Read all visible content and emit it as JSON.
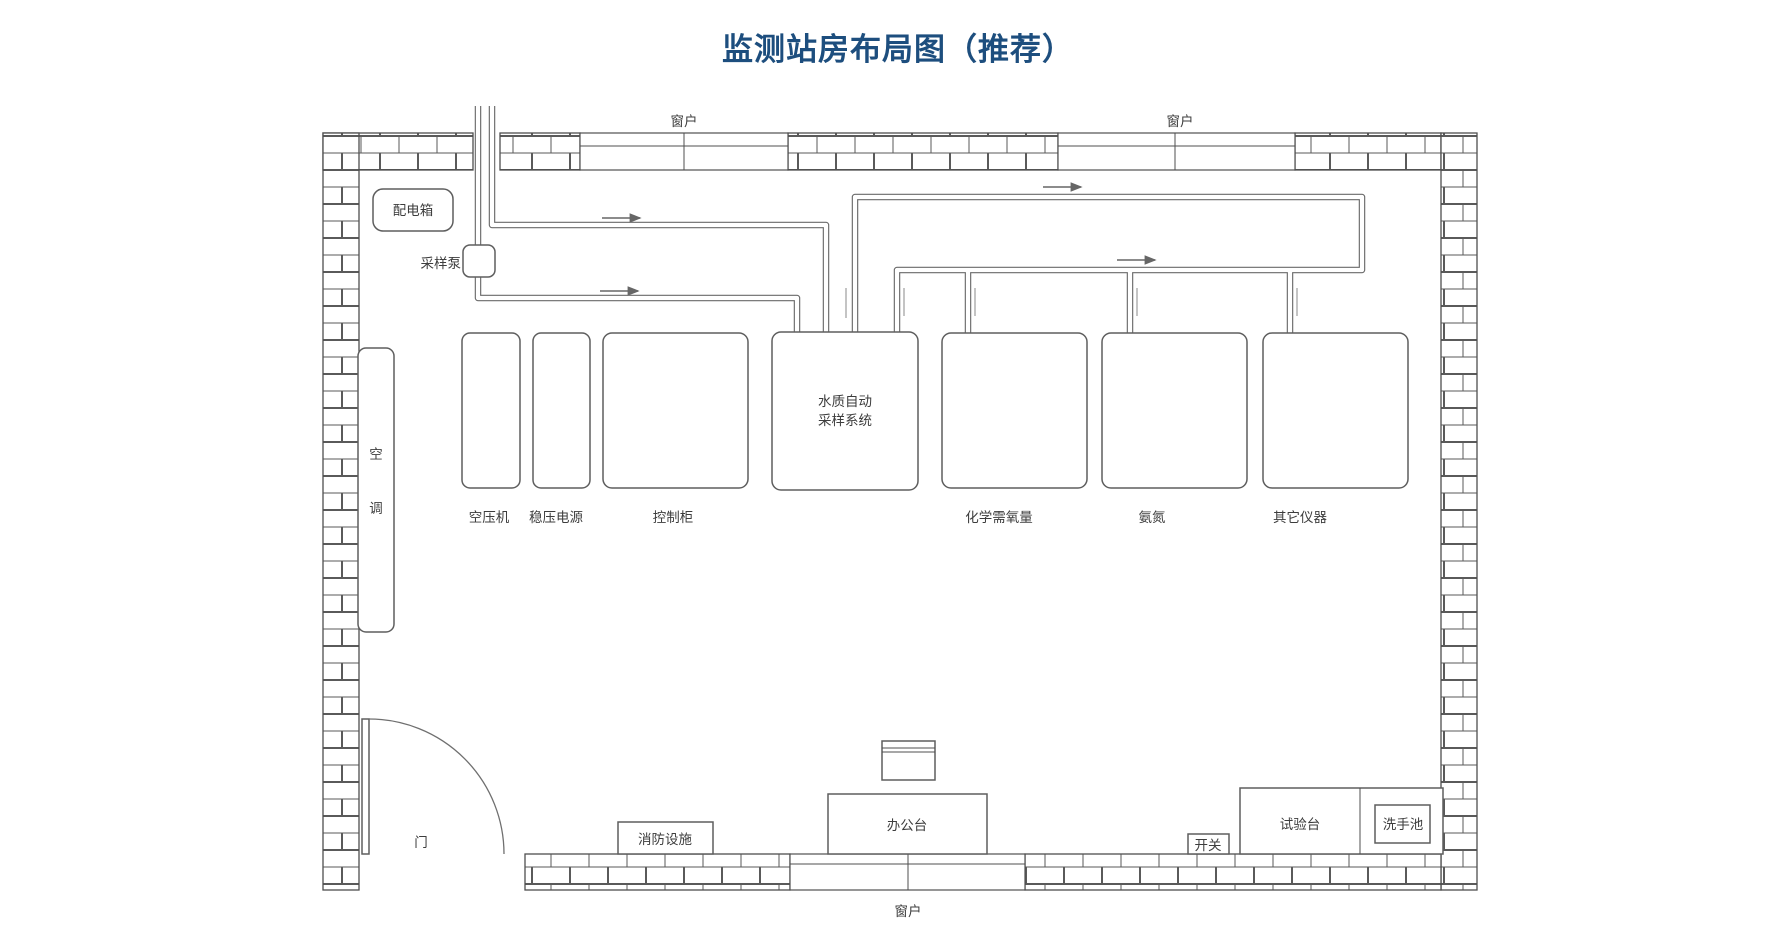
{
  "title": "监测站房布局图（推荐）",
  "colors": {
    "title": "#1d4e7e",
    "line": "#6a6a6a",
    "wall": "#4f4f4f",
    "text": "#3d3d3d",
    "background": "#ffffff"
  },
  "windows": {
    "top_left": "窗户",
    "top_right": "窗户",
    "bottom": "窗户"
  },
  "equipment": {
    "distribution_box": "配电箱",
    "sampling_pump": "采样泵",
    "air_conditioner_char1": "空",
    "air_conditioner_char2": "调",
    "air_compressor": "空压机",
    "regulated_power": "稳压电源",
    "control_cabinet": "控制柜",
    "sampling_system_line1": "水质自动",
    "sampling_system_line2": "采样系统",
    "cod": "化学需氧量",
    "ammonia": "氨氮",
    "other_instruments": "其它仪器",
    "door": "门",
    "fire_equipment": "消防设施",
    "office_desk": "办公台",
    "switch": "开关",
    "test_bench": "试验台",
    "sink": "洗手池"
  }
}
